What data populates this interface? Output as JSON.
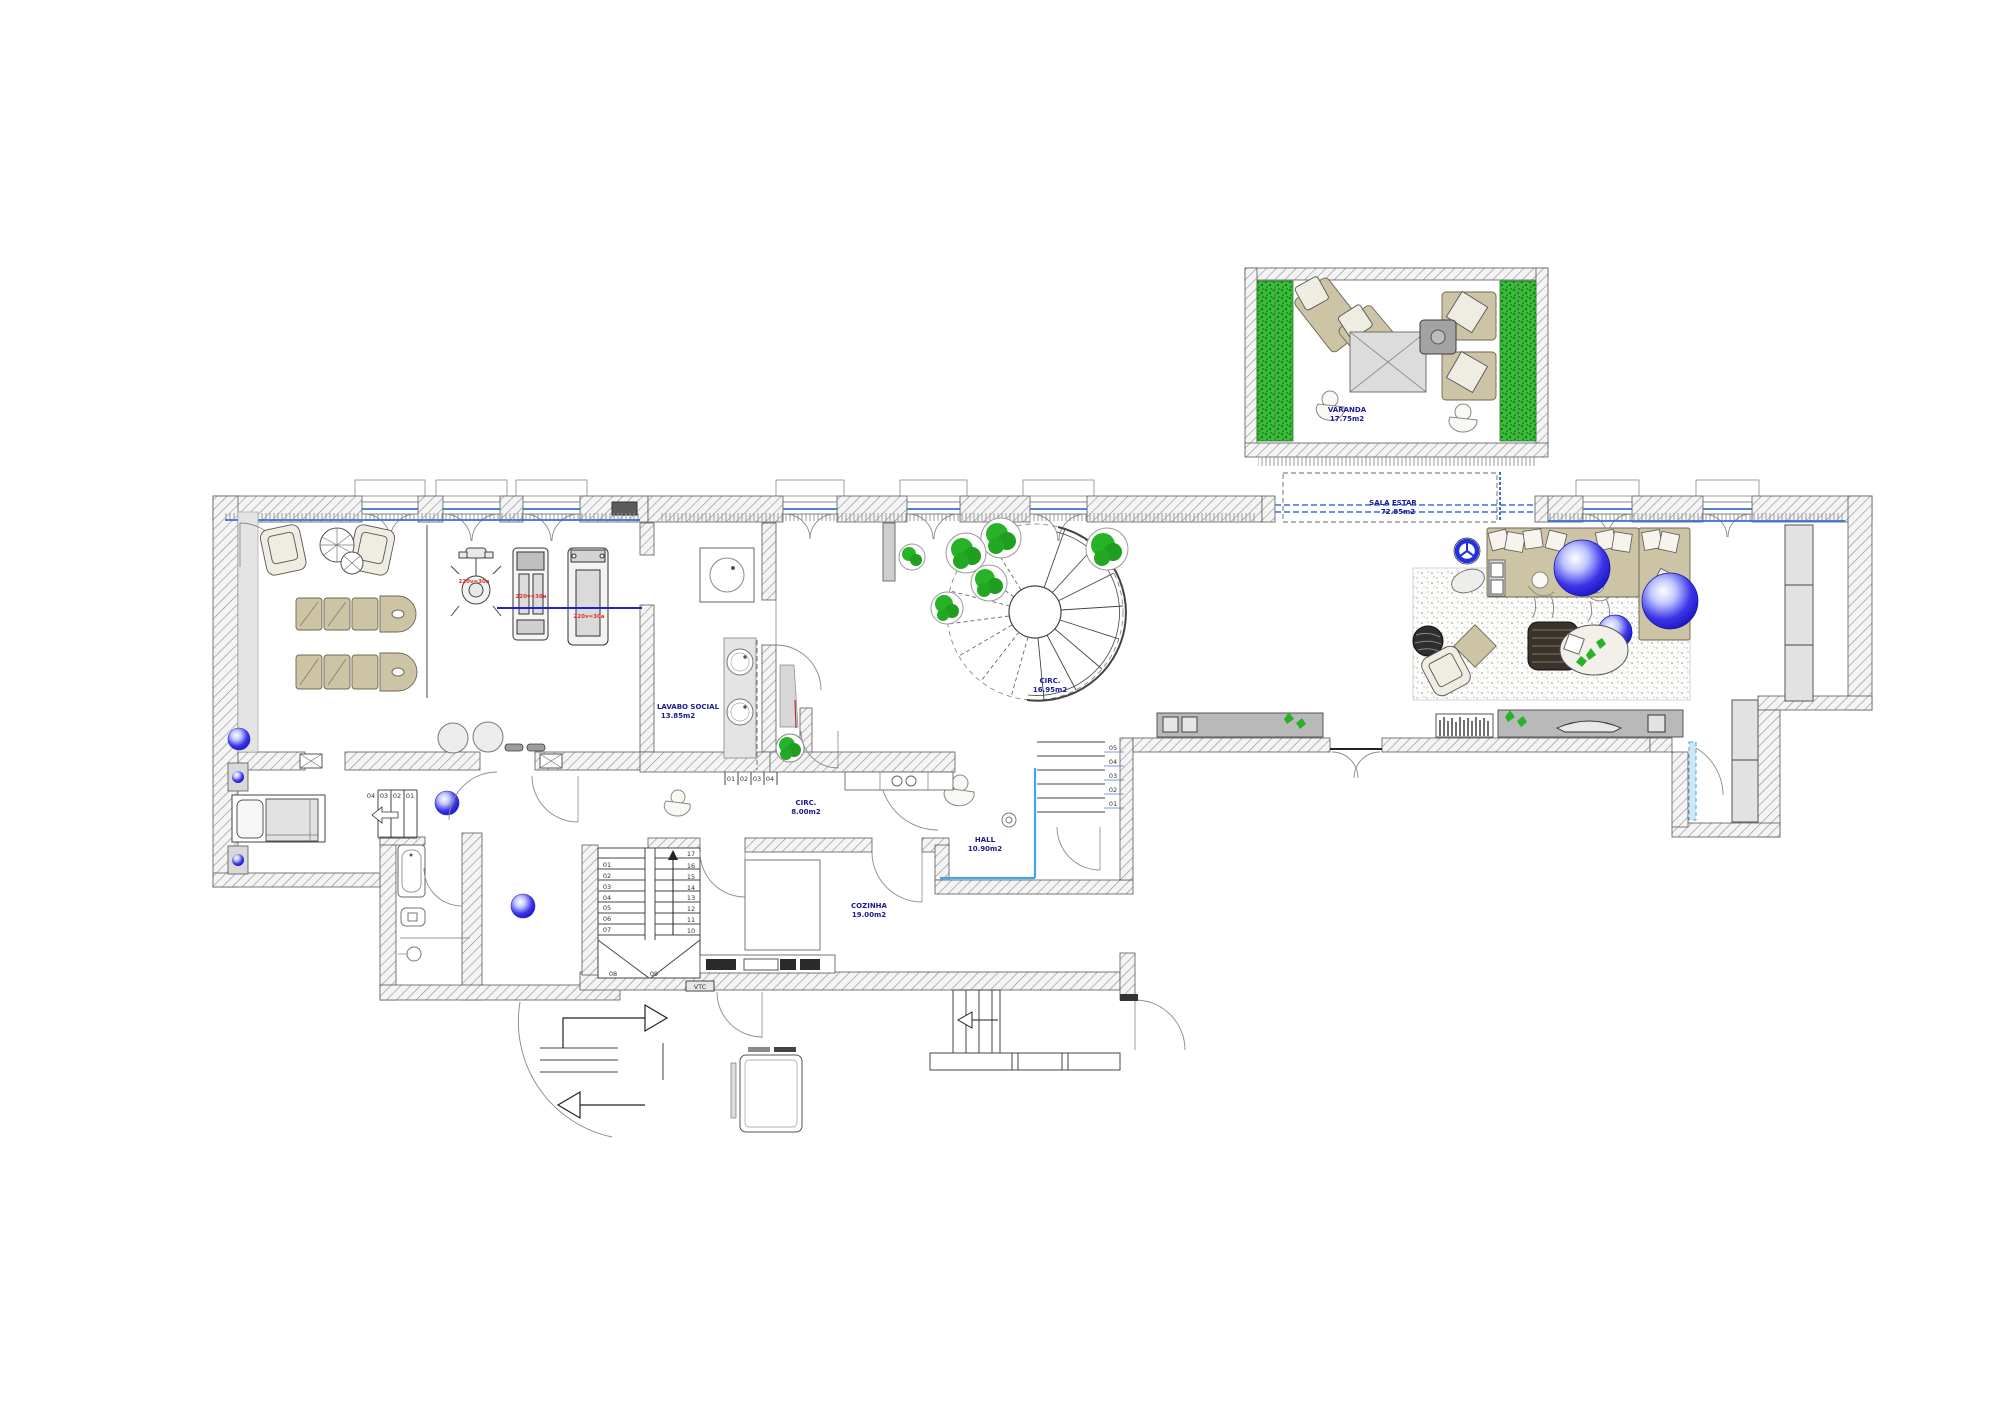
{
  "plan": {
    "title": "apartment-floor-plan",
    "labels": {
      "varanda": {
        "name": "VARANDA",
        "area": "17.75m2"
      },
      "sala_estar": {
        "name": "SALA ESTAR",
        "area": "72.85m2"
      },
      "lavabo": {
        "name": "LAVABO SOCIAL",
        "area": "13.85m2"
      },
      "circ_main": {
        "name": "CIRC.",
        "area": "16.95m2"
      },
      "circ_small": {
        "name": "CIRC.",
        "area": "8.00m2"
      },
      "hall": {
        "name": "HALL",
        "area": "10.90m2"
      },
      "lavandaria": {
        "name": "LAVANDARIA",
        "area": "3.65m2"
      },
      "cozinha": {
        "name": "COZINHA",
        "area": "19.00m2"
      }
    },
    "stairs": {
      "main": {
        "left": [
          "01",
          "02",
          "03",
          "04",
          "05",
          "06",
          "07"
        ],
        "right": [
          "17",
          "16",
          "15",
          "14",
          "13",
          "12",
          "11",
          "10"
        ],
        "bottom": [
          "08",
          "09"
        ]
      },
      "bedroom_steps": [
        "04",
        "03",
        "02",
        "01"
      ],
      "hall_steps": [
        "05",
        "04",
        "03",
        "02",
        "01"
      ]
    },
    "annotations": {
      "gym_power_1": "220v=30a",
      "gym_power_2": "220v=30a",
      "gym_power_3": "220v=30a",
      "vtc": "VTC"
    },
    "colors": {
      "label_blue": "#1b1b8f",
      "sill_blue": "#3a6fd8",
      "hall_cyan": "#45a5e6",
      "plant_green": "#28b228",
      "equipment_red": "#e03030",
      "furniture_tan": "#cdc4a6",
      "sphere_blue": "#1414c8"
    }
  }
}
